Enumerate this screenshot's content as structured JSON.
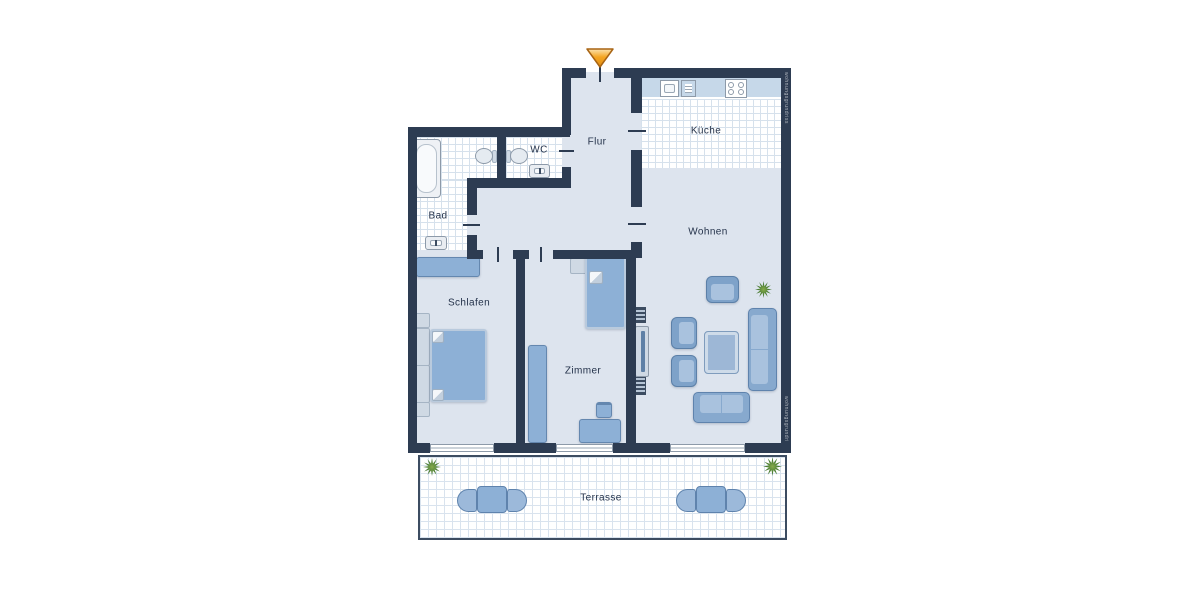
{
  "rooms": [
    {
      "name": "bad",
      "label": "Bad"
    },
    {
      "name": "wc",
      "label": "WC"
    },
    {
      "name": "flur",
      "label": "Flur"
    },
    {
      "name": "kueche",
      "label": "Küche"
    },
    {
      "name": "wohnen",
      "label": "Wohnen"
    },
    {
      "name": "schlafen",
      "label": "Schlafen"
    },
    {
      "name": "zimmer",
      "label": "Zimmer"
    },
    {
      "name": "terrasse",
      "label": "Terrasse"
    }
  ],
  "watermarks": {
    "right_top": "wohnungsgrundriss",
    "right_bottom": "wohnungsgrundriss"
  },
  "colors": {
    "wall": "#2d3c52",
    "floor": "#dde4ee",
    "tile_line": "#d6e1ec",
    "furniture_blue": "#8db0d6",
    "furniture_light": "#cfd9e4",
    "counter": "#c6d8e9",
    "entrance_arrow": "#f5a623",
    "plant_green": "#4a7d35",
    "window_frame": "#8d9aa9"
  },
  "icons": [
    "entrance-arrow-icon",
    "bathtub-icon",
    "toilet-icon",
    "washbasin-icon",
    "kitchen-sink-icon",
    "dishwasher-icon",
    "stove-icon",
    "double-bed-icon",
    "single-bed-icon",
    "wardrobe-icon",
    "dresser-icon",
    "desk-icon",
    "desk-chair-icon",
    "sofa-icon",
    "armchair-icon",
    "coffee-table-icon",
    "tv-sideboard-icon",
    "radiator-icon",
    "plant-icon",
    "terrace-table-icon",
    "terrace-chair-icon"
  ]
}
